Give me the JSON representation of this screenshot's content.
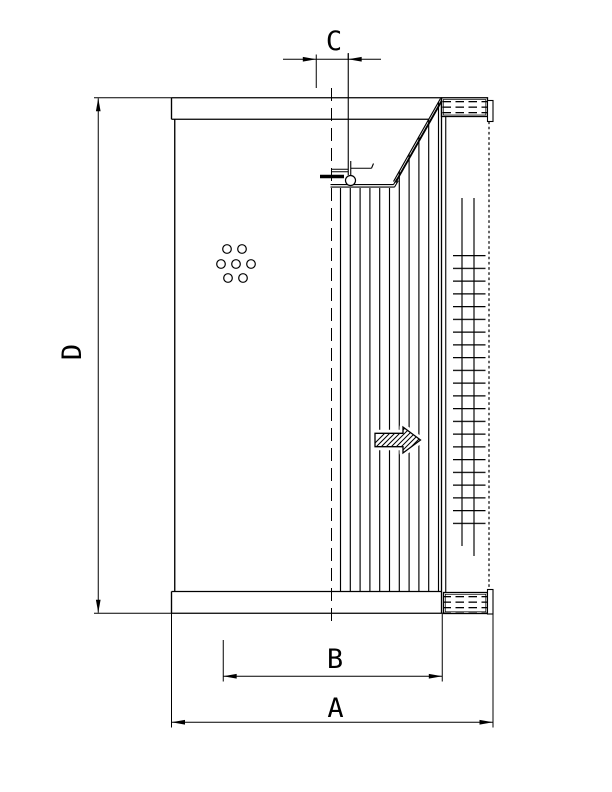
{
  "page": {
    "background_color": "#ffffff",
    "line_color": "#000000",
    "kind": "technical dimensional drawing"
  },
  "dimension_labels": {
    "a": "A",
    "b": "B",
    "c": "C",
    "d": "D"
  },
  "icons": {
    "flow_arrow": "flow-direction-right-arrow",
    "perforation_holes": "seven-hole-cluster",
    "hatch": "dashed-end-cap-hatch"
  }
}
